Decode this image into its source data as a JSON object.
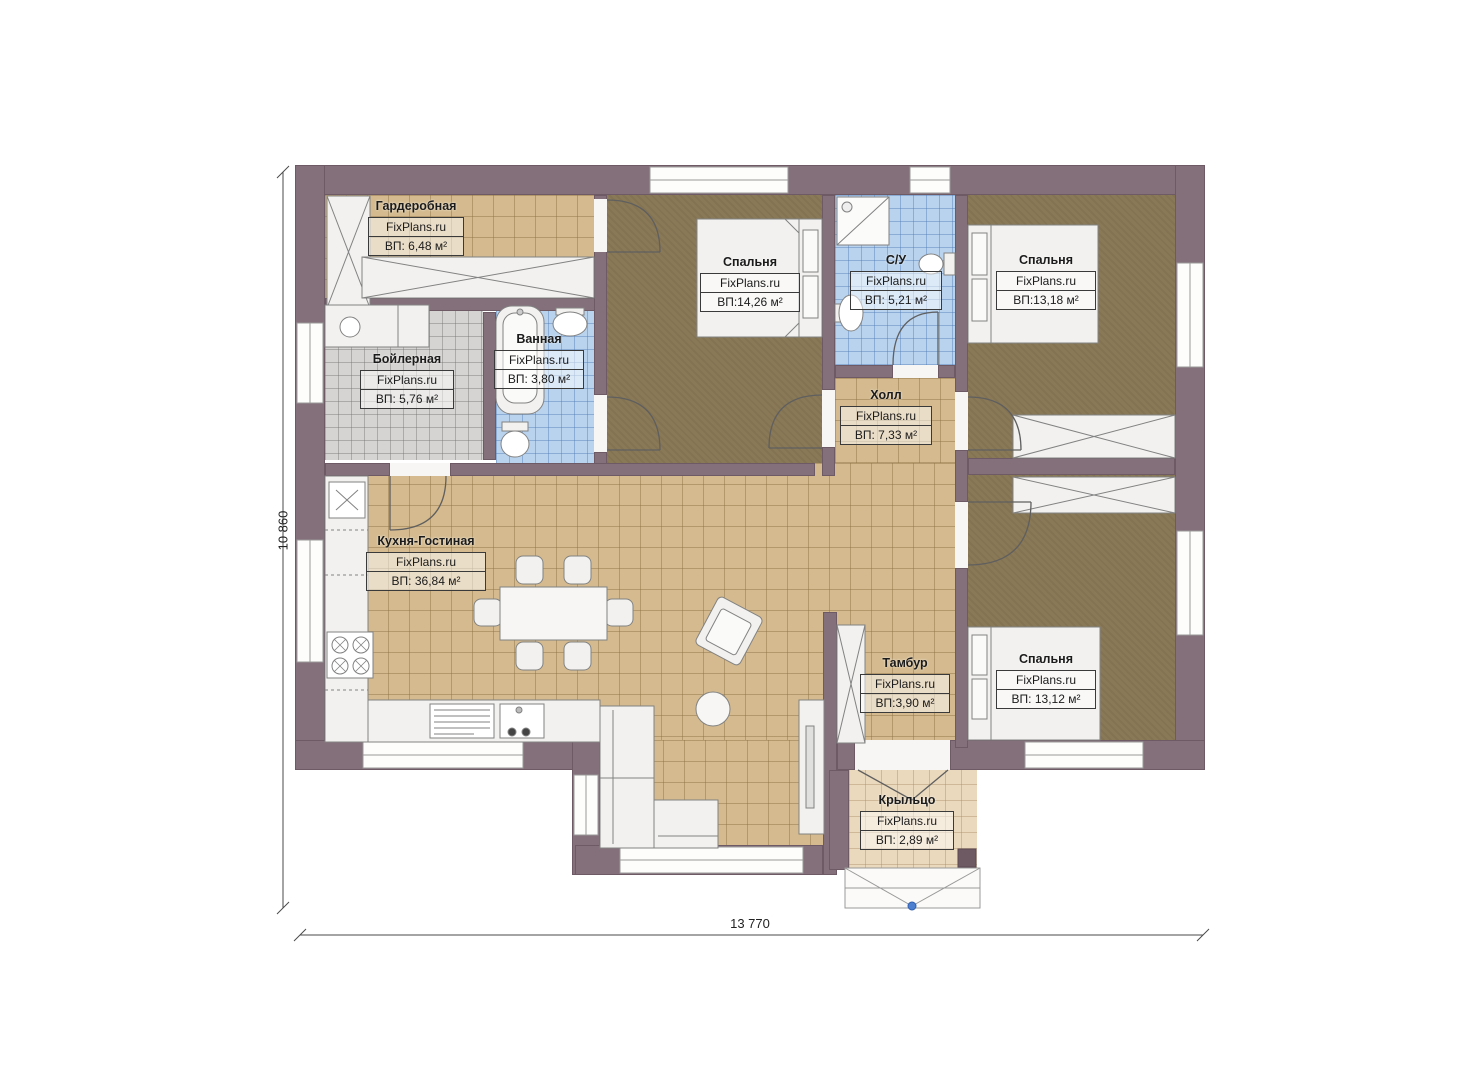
{
  "plan": {
    "watermark": "FixPlans.ru",
    "dimensions": {
      "height_label": "10 860",
      "width_label": "13 770"
    },
    "rooms": [
      {
        "name": "Гардеробная",
        "area": "ВП: 6,48 м²"
      },
      {
        "name": "Бойлерная",
        "area": "ВП: 5,76 м²"
      },
      {
        "name": "Ванная",
        "area": "ВП: 3,80 м²"
      },
      {
        "name": "Спальня",
        "area": "ВП:14,26 м²"
      },
      {
        "name": "С/У",
        "area": "ВП: 5,21 м²"
      },
      {
        "name": "Спальня",
        "area": "ВП:13,18 м²"
      },
      {
        "name": "Холл",
        "area": "ВП: 7,33 м²"
      },
      {
        "name": "Кухня-Гостиная",
        "area": "ВП: 36,84 м²"
      },
      {
        "name": "Тамбур",
        "area": "ВП:3,90 м²"
      },
      {
        "name": "Спальня",
        "area": "ВП: 13,12 м²"
      },
      {
        "name": "Крыльцо",
        "area": "ВП: 2,89 м²"
      }
    ],
    "colors": {
      "wall": "#84707a",
      "tile_tan": "#d4ba8e",
      "tile_blue": "#b9d3ee",
      "tile_gray": "#d6d4d2",
      "carpet_brown": "#8a7957",
      "porch_beige": "#ead9bd",
      "entry_marker": "#4d7fd0"
    }
  }
}
